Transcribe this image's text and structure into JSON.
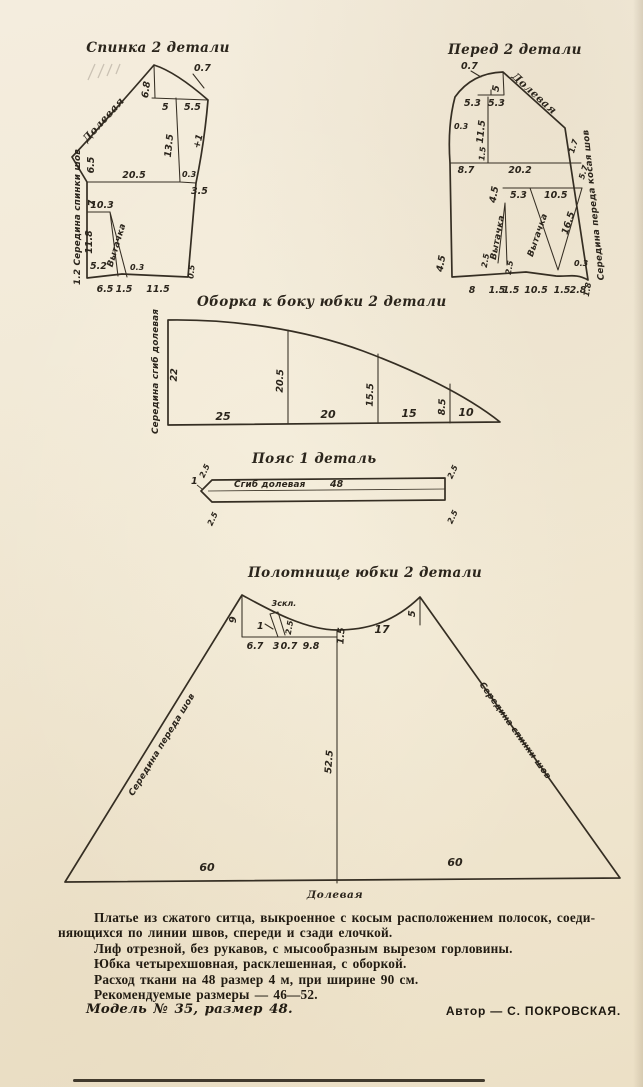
{
  "paper": {
    "bg": "#f1e8d5",
    "ink": "#2e2820"
  },
  "back": {
    "title": "Спинка 2 детали",
    "grain": "Долевая",
    "seam": "1.2 Середина спинки шов",
    "dart": "Вытачка",
    "m": {
      "ease": "0.7",
      "neck_h": "6.8",
      "neck_a": "5",
      "neck_b": "5.5",
      "armhole": "13.5",
      "side_ease": "+1",
      "seg1": "6.5",
      "width": "20.5",
      "notch": "0.3",
      "step": "3.5",
      "seg2": "7",
      "dart_pos": "10.3",
      "seg3": "11.8",
      "seg4": "5.2",
      "hem_rise": "0.3",
      "hem1": "6.5",
      "hem2": "1.5",
      "hem3": "11.5",
      "corner": "0.5"
    }
  },
  "front": {
    "title": "Перед 2 детали",
    "grain": "Долевая",
    "seam": "Середина переда косая шов",
    "dart": "Вытачка",
    "m": {
      "ease": "0.7",
      "neck_top": "5",
      "neck_a": "5.3",
      "neck_b": "5.3",
      "left_curve": "0.3",
      "armhole": "11.5",
      "tick": "1.5",
      "bust_a": "8.7",
      "bust_b": "20.2",
      "side_a": "1.7",
      "side_b": "5.7",
      "dart1_h": "4.5",
      "dart2_a": "5.3",
      "dart2_b": "10.5",
      "dart2_side": "16.5",
      "side_notch": "0.3",
      "left_h": "4.5",
      "small_a": "2.5",
      "small_b": "2.5",
      "hem_a": "8",
      "hem_b": "1.5",
      "hem_c": "1.5",
      "hem_d": "10.5",
      "hem_e": "1.5",
      "hem_f": "2.8",
      "corner": "1.8"
    }
  },
  "ruffle": {
    "title": "Оборка к боку юбки 2 детали",
    "side": "Середина сгиб долевая",
    "h": [
      "22",
      "20.5",
      "15.5",
      "8.5"
    ],
    "w": [
      "25",
      "20",
      "15",
      "10"
    ]
  },
  "belt": {
    "title": "Пояс 1 деталь",
    "fold": "Сгиб долевая",
    "len": "48",
    "tip": "1",
    "c": [
      "2.5",
      "2.5",
      "2.5",
      "2.5"
    ]
  },
  "skirt": {
    "title": "Полотнище юбки 2 детали",
    "left_seam": "Середина переда шов",
    "right_seam": "Середина спинки шов",
    "grain": "Долевая",
    "pleat": "3скл.",
    "m": {
      "left_v": "9",
      "one": "1",
      "pleat_w": "2.5",
      "wa": "6.7",
      "wb": "3",
      "wc": "0.7",
      "wd": "9.8",
      "notch": "1.5",
      "right_w": "17",
      "right_v": "5",
      "length": "52.5",
      "hem_l": "60",
      "hem_r": "60"
    }
  },
  "description": {
    "para1a": "Платье из сжатого ситца, выкроенное с косым расположением полосок, соеди-",
    "para1b": "няющихся по линии швов, спереди и сзади елочкой.",
    "line2": "Лиф отрезной, без рукавов, с мысообразным вырезом горловины.",
    "line3": "Юбка четырехшовная, расклешенная, с оборкой.",
    "line4": "Расход ткани на 48 размер 4 м, при ширине 90 см.",
    "line5": "Рекомендуемые размеры — 46—52.",
    "line6": "Модель № 35, размер 48.",
    "author": "Автор — С. ПОКРОВСКАЯ."
  }
}
